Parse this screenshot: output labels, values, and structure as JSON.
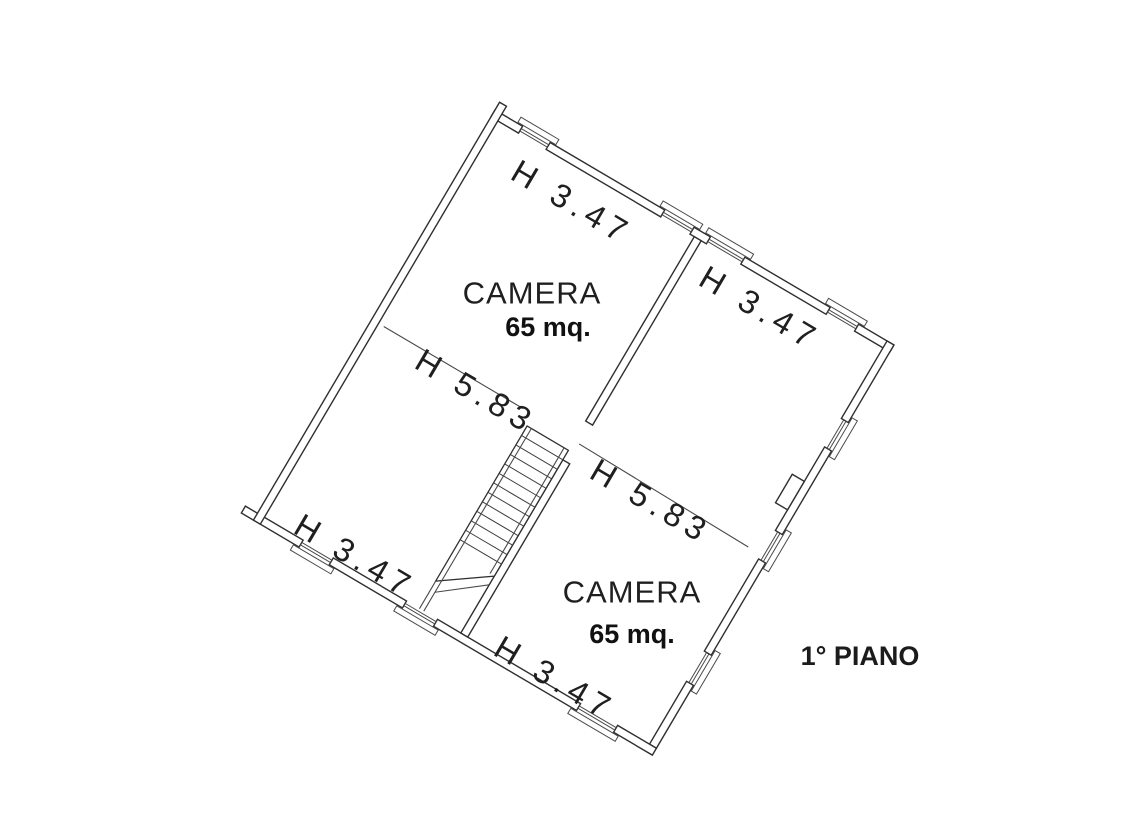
{
  "drawing": {
    "background": "#ffffff",
    "line_color": "#2f2f2f",
    "floor_label": {
      "text": "1° PIANO",
      "color": "#2d3192"
    },
    "rooms": [
      {
        "name": "CAMERA",
        "area": "65 mq."
      },
      {
        "name": "CAMERA",
        "area": "65 mq."
      }
    ],
    "dimension_labels": {
      "wall_top_left": "H 3.47",
      "wall_top_right": "H 3.47",
      "ridge_left": "H 5.83",
      "ridge_right": "H 5.83",
      "wall_bottom_left": "H 3.47",
      "wall_bottom": "H 3.47"
    }
  }
}
